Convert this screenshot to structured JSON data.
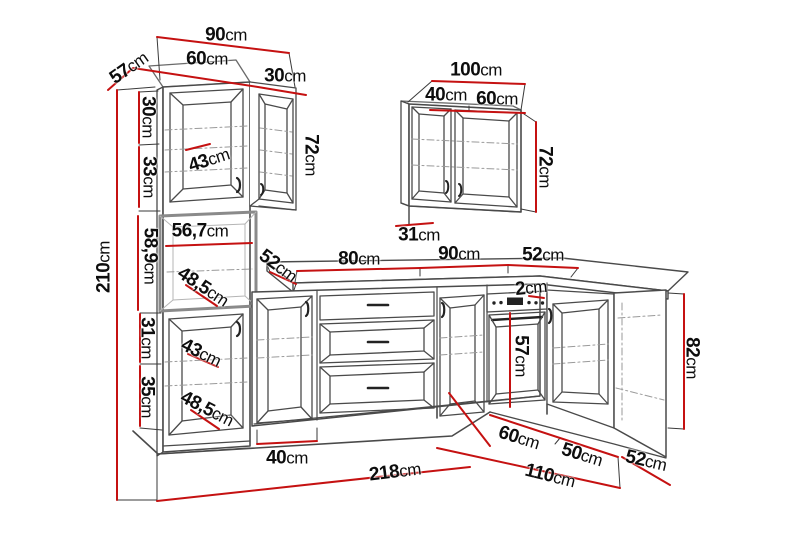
{
  "title": "Kitchen cabinet set dimensional drawing",
  "units": "cm",
  "colors": {
    "dimension_line": "#c51111",
    "outline": "#4a4a4a",
    "label": "#0d0d0d"
  },
  "labels": {
    "tall_top_width": {
      "value": "90",
      "unit": "cm"
    },
    "tall_front_width": {
      "value": "60",
      "unit": "cm"
    },
    "wall_left_width": {
      "value": "30",
      "unit": "cm"
    },
    "tall_depth": {
      "value": "57",
      "unit": "cm"
    },
    "upper_section_a": {
      "value": "30",
      "unit": "cm"
    },
    "upper_section_b": {
      "value": "33",
      "unit": "cm"
    },
    "upper_door_diag": {
      "value": "43",
      "unit": "cm"
    },
    "wall_left_height": {
      "value": "72",
      "unit": "cm"
    },
    "total_height": {
      "value": "210",
      "unit": "cm"
    },
    "niche_height": {
      "value": "58,9",
      "unit": "cm"
    },
    "niche_width": {
      "value": "56,7",
      "unit": "cm"
    },
    "niche_diag": {
      "value": "48,5",
      "unit": "cm"
    },
    "lower_section_a": {
      "value": "31",
      "unit": "cm"
    },
    "lower_section_b": {
      "value": "35",
      "unit": "cm"
    },
    "lower_door_diag": {
      "value": "43",
      "unit": "cm"
    },
    "lower_door_diag2": {
      "value": "48,5",
      "unit": "cm"
    },
    "counter_depth_left": {
      "value": "52",
      "unit": "cm"
    },
    "counter_span_a": {
      "value": "80",
      "unit": "cm"
    },
    "counter_span_b": {
      "value": "90",
      "unit": "cm"
    },
    "counter_span_c": {
      "value": "52",
      "unit": "cm"
    },
    "counter_thickness": {
      "value": "2",
      "unit": "cm"
    },
    "wall_right_depth": {
      "value": "31",
      "unit": "cm"
    },
    "wall_right_width": {
      "value": "100",
      "unit": "cm"
    },
    "wall_right_door_a": {
      "value": "40",
      "unit": "cm"
    },
    "wall_right_door_b": {
      "value": "60",
      "unit": "cm"
    },
    "wall_right_height": {
      "value": "72",
      "unit": "cm"
    },
    "oven_height": {
      "value": "57",
      "unit": "cm"
    },
    "base_height": {
      "value": "82",
      "unit": "cm"
    },
    "right_run_a": {
      "value": "60",
      "unit": "cm"
    },
    "right_run_b": {
      "value": "50",
      "unit": "cm"
    },
    "right_run_depth": {
      "value": "52",
      "unit": "cm"
    },
    "right_run_total": {
      "value": "110",
      "unit": "cm"
    },
    "base_door_width": {
      "value": "40",
      "unit": "cm"
    },
    "left_run_total": {
      "value": "218",
      "unit": "cm"
    }
  }
}
